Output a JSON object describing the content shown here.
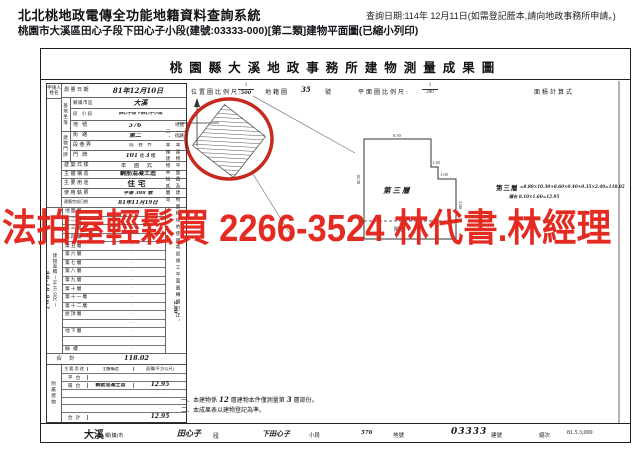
{
  "header": {
    "system_title": "北北桃地政電傳全功能地籍資料查詢系統",
    "query_note": "查詢日期:114年 12月11日(如需登記謄本,請向地政事務所申請。)",
    "doc_line": "桃園市大溪區田心子段下田心子小段(建號:03333-000)[第二類]建物平面圖(已縮小列印)"
  },
  "watermark": {
    "text": "法拍屋輕鬆買 2266-3524 林代書.林經理",
    "color": "#e2231a"
  },
  "colors": {
    "red_circle": "#c62a1f",
    "ink": "#1a1a1a"
  },
  "sheet": {
    "title": "桃園縣大溪地政事務所建物測量成果圖",
    "scale": {
      "loc_label": "位置圖比例尺:",
      "loc_num": "1",
      "loc_den": "500",
      "cad_label": "地籍圖",
      "cad_no": "35",
      "cad_unit": "號",
      "plan_label": "平面圖比例尺:",
      "plan_num": "1",
      "plan_den": "200",
      "calc_label": "面積計算式"
    },
    "form": {
      "applicant_line1": "申請人",
      "applicant_line2": "姓名",
      "margin_scribble": "90-10 9m2",
      "survey": {
        "label": "測量日期",
        "value": "81年12月10日"
      },
      "site_group": "基地坐落",
      "district": {
        "label": "鄉鎮市區",
        "value": "大溪"
      },
      "section": {
        "label": "段 小段",
        "value": "田心子段下田心子小段"
      },
      "parcel": {
        "label": "地 號",
        "value": "576",
        "unit": "地號"
      },
      "addr_group": "建物門牌",
      "street": {
        "label": "街 路",
        "value": "東二",
        "unit": "街路"
      },
      "lane": {
        "label": "段巷弄",
        "unit": "段　巷　弄"
      },
      "door": {
        "label": "門 牌",
        "no1": "101",
        "unit1": "號",
        "no2": "3",
        "unit2": "樓"
      },
      "style": {
        "label": "建築式樣",
        "value": "本 國 式"
      },
      "structure": {
        "label": "主體構造",
        "value": "鋼筋混凝土造"
      },
      "usage": {
        "label": "主要用途",
        "value": "住宅"
      },
      "license": {
        "label": "使用執照",
        "value": "字第 388 號"
      },
      "completion": {
        "label": "建築完成日期",
        "value": "81年11月19日"
      },
      "area_col_label": "建物面積(平方公尺)",
      "floors": [
        {
          "label": "地面層",
          "value": "·"
        },
        {
          "label": "第二層",
          "value": "·"
        },
        {
          "label": "第三層",
          "value": "·"
        },
        {
          "label": "第四層",
          "value": "·"
        },
        {
          "label": "第五層",
          "value": "·"
        },
        {
          "label": "第六層",
          "value": "·"
        },
        {
          "label": "第七層",
          "value": "·"
        },
        {
          "label": "第八層",
          "value": "·"
        },
        {
          "label": "第九層",
          "value": "·"
        },
        {
          "label": "第十層",
          "value": "·"
        },
        {
          "label": "第十一層",
          "value": "·"
        },
        {
          "label": "第十二層",
          "value": "·"
        },
        {
          "label": "屋頂層",
          "value": "·"
        },
        {
          "label": "",
          "value": "·"
        },
        {
          "label": "地下層",
          "value": "·"
        },
        {
          "label": "",
          "value": "·"
        },
        {
          "label": "騎 樓",
          "value": "·"
        }
      ],
      "total": {
        "label": "合 計",
        "value": "118.02"
      },
      "annex": {
        "side_label": "附屬建物",
        "head": {
          "use": "主要用途",
          "structure": "主體構造",
          "area": "面積(平方公尺)"
        },
        "rows": [
          {
            "use": "平 台",
            "structure": "",
            "area": "·"
          },
          {
            "use": "陽 台",
            "structure": "鋼筋混凝土造",
            "area": "12.95"
          },
          {
            "use": "",
            "structure": "",
            "area": "·"
          },
          {
            "use": "",
            "structure": "",
            "area": "·"
          },
          {
            "use": "",
            "structure": "",
            "area": "·"
          }
        ],
        "total": {
          "label": "合 計",
          "area": "12.95"
        }
      }
    },
    "plan": {
      "label": "第三層",
      "balcony": "陽台",
      "dim_top": "8.50",
      "dim_left": "10.30",
      "dim_step1": "1.40",
      "dim_step2": "1.00",
      "dim_right": "2.00",
      "calc_title": "第三層",
      "calc_line1": "=8.80×10.30+8.60×0.40+0.35×2.40=118.02",
      "calc_line2": "陽台 8.10×1.60=12.95"
    },
    "notes": {
      "v1": "一、本建物平面圖及建物面積係依使用執照竣工平面圖轉繪訂正。",
      "v2": "二、本棟建物共拾貳層等",
      "v_scribble": "2.00",
      "b1_pre": "一、本建物係",
      "b1_n1": "12",
      "b1_mid": "層建物本件僅測量第",
      "b1_n2": "3",
      "b1_post": "層部份。",
      "b2": "二、本成果表以建物登記為準。"
    },
    "footer": {
      "name1": "大溪",
      "unit1": "鄉(鎮)市",
      "name2": "田心子",
      "unit2": "段",
      "name3": "下田心子",
      "unit3": "小段",
      "parcel": "576",
      "parcel_unit": "地號",
      "building": "03333",
      "building_unit": "建號",
      "ed_label": "縮次",
      "ed_value": "81.5.3,000"
    }
  }
}
